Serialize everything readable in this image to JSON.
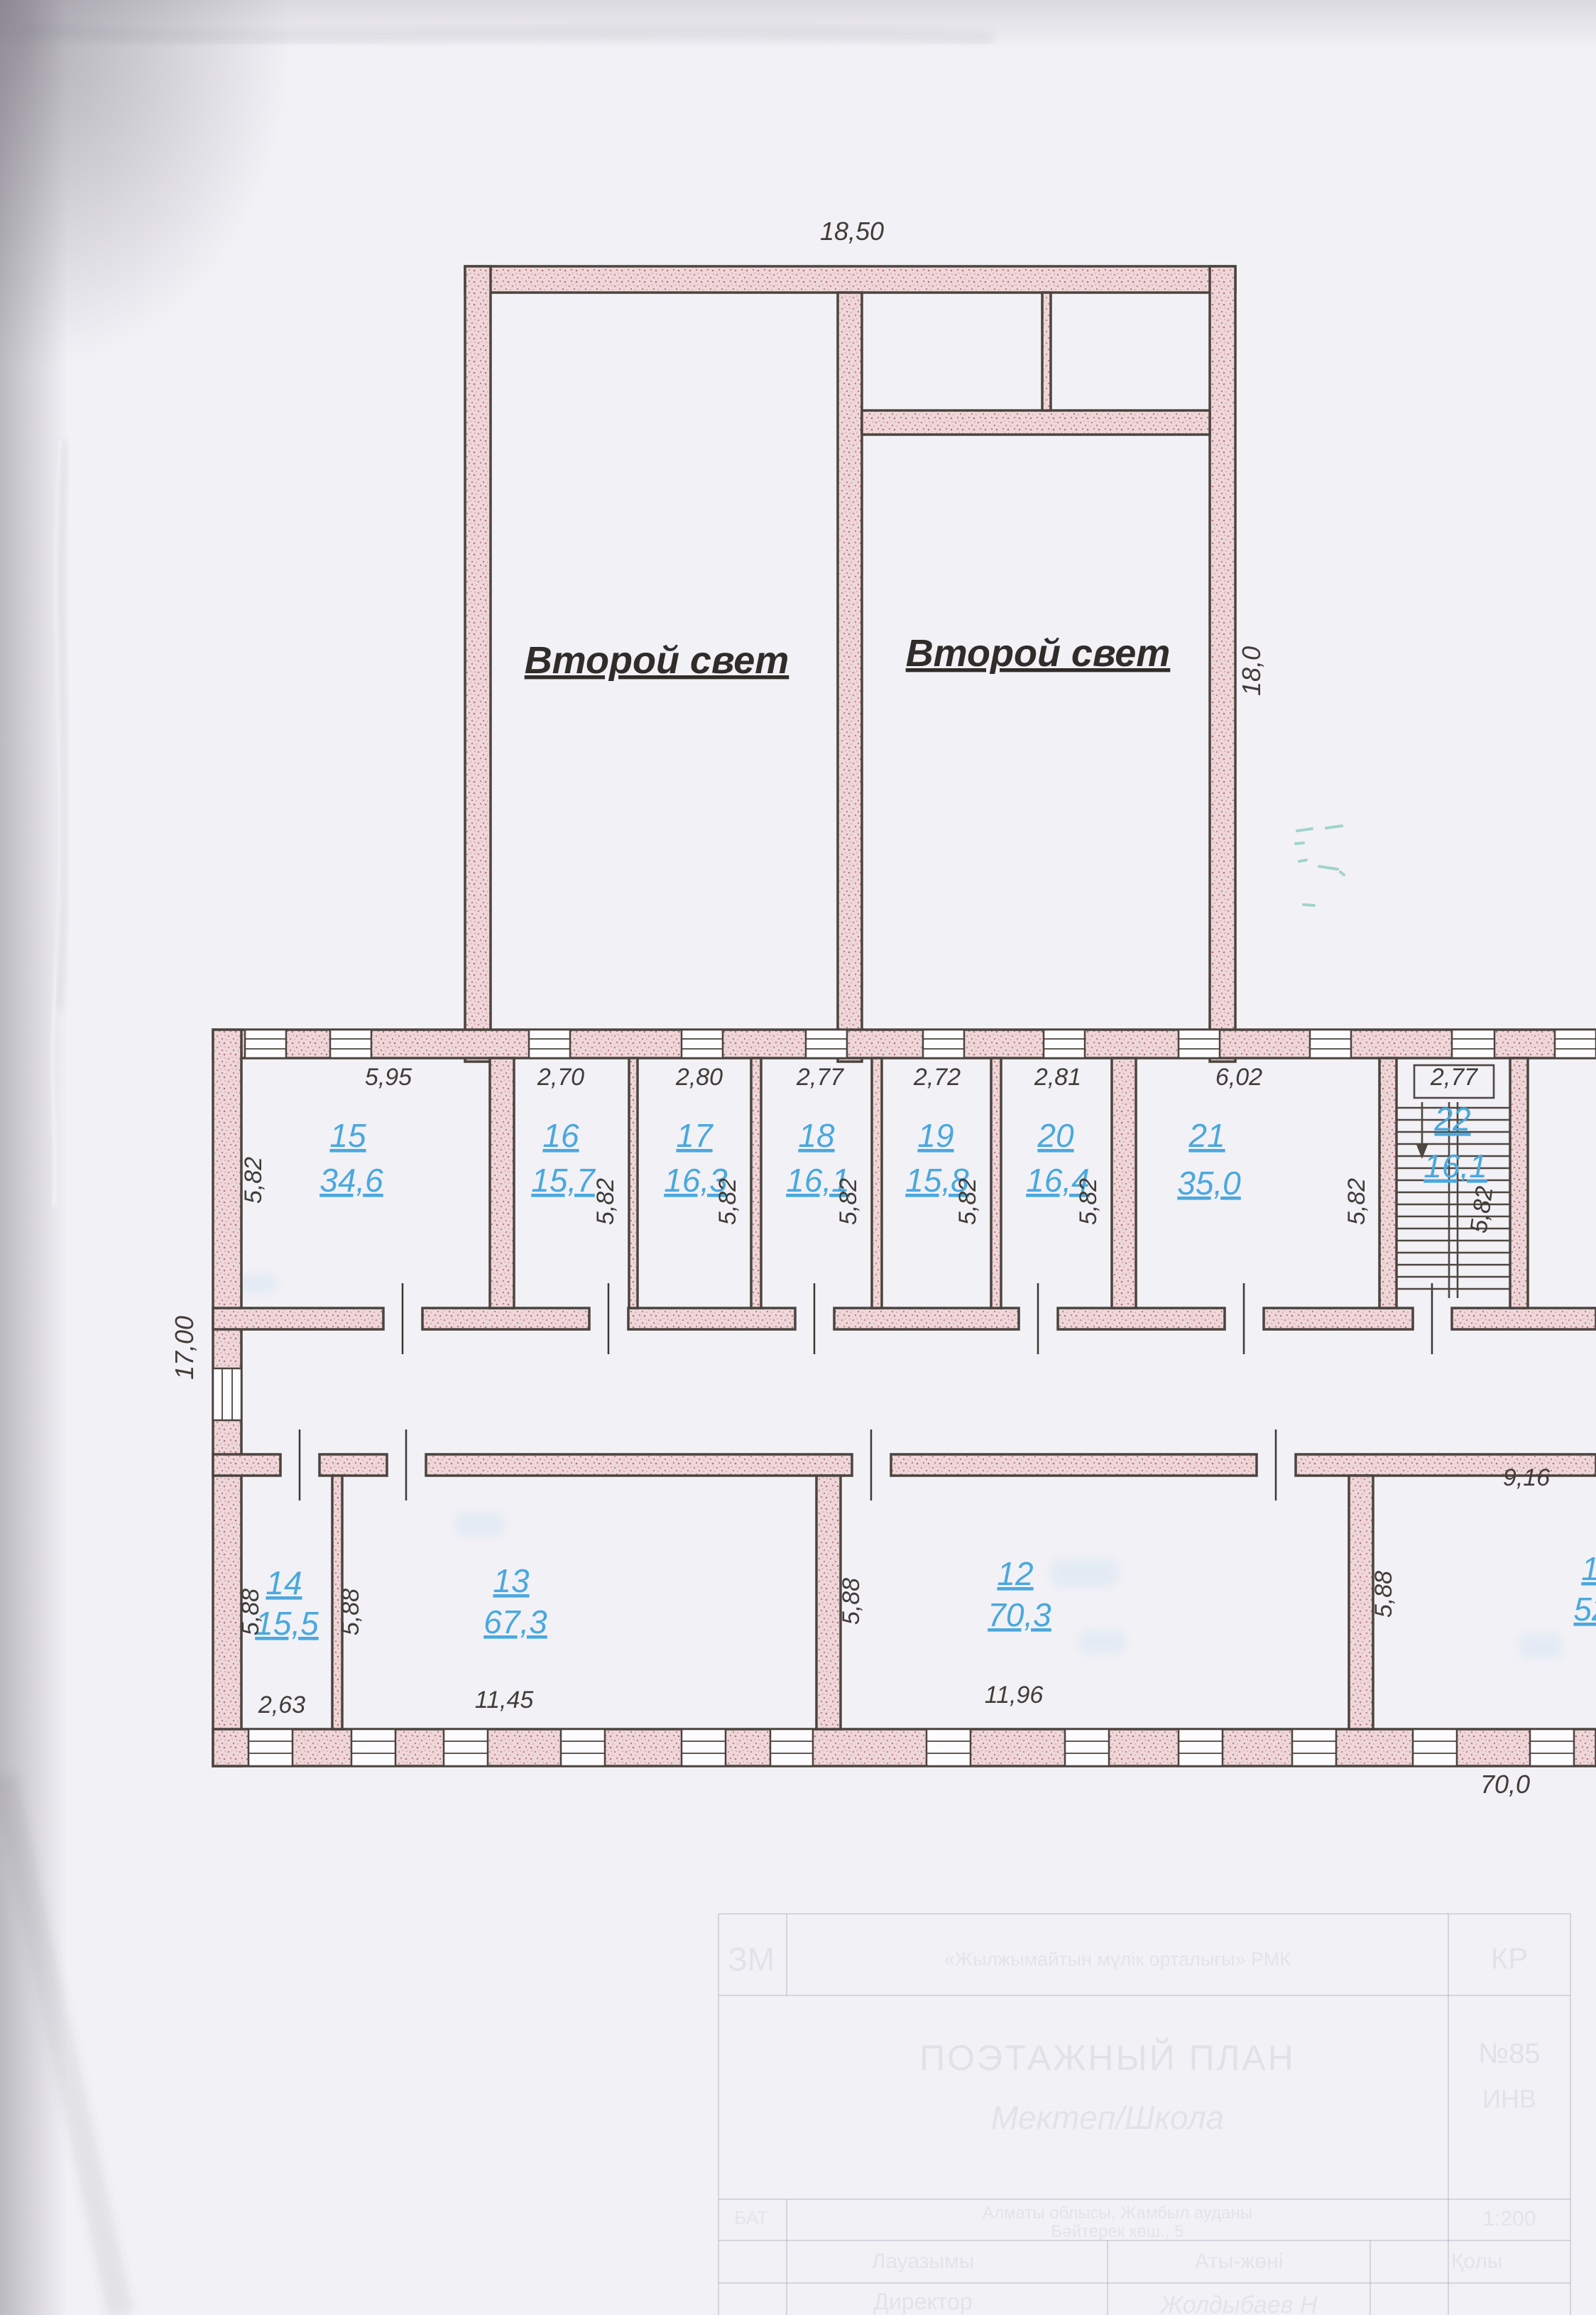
{
  "document": {
    "kind": "scanned floor plan sheet",
    "accent_blue": "#4aa8de",
    "wall_pink": "#eed7d9",
    "paper": "#f2f1f6"
  },
  "annotations": {
    "second_light_left": "Второй свет",
    "second_light_right": "Второй свет"
  },
  "overall_dimensions": {
    "top_width": "18,50",
    "right_height": "18,0",
    "left_height": "17,00",
    "bottom_length": "70,0"
  },
  "upper_rooms": [
    {
      "number": "15",
      "area": "34,6",
      "width": "5,95",
      "depth": "5,82"
    },
    {
      "number": "16",
      "area": "15,7",
      "width": "2,70",
      "depth": "5,82"
    },
    {
      "number": "17",
      "area": "16,3",
      "width": "2,80",
      "depth": "5,82"
    },
    {
      "number": "18",
      "area": "16,1",
      "width": "2,77",
      "depth": "5,82"
    },
    {
      "number": "19",
      "area": "15,8",
      "width": "2,72",
      "depth": "5,82"
    },
    {
      "number": "20",
      "area": "16,4",
      "width": "2,81",
      "depth": "5,82"
    },
    {
      "number": "21",
      "area": "35,0",
      "width": "6,02",
      "depth": "5,82"
    },
    {
      "number": "22",
      "area": "16,1",
      "width": "2,77",
      "depth": "5,82"
    }
  ],
  "lower_rooms": [
    {
      "number": "14",
      "area": "15,5",
      "width": "2,63",
      "depth": "5,88"
    },
    {
      "number": "13",
      "area": "67,3",
      "width": "11,45",
      "depth": "5,88"
    },
    {
      "number": "12",
      "area": "70,3",
      "width": "11,96",
      "depth": "5,88"
    },
    {
      "number": "1",
      "area": "52",
      "width": "9,16",
      "depth": "5,88"
    }
  ],
  "title_block": {
    "org_code_left": "ЗМ",
    "org_name": "«Жылжымайтын мүлік орталығы» РМК",
    "region_code": "КР",
    "plan_title": "ПОЭТАЖНЫЙ ПЛАН",
    "object_name": "Мектеп/Школа",
    "inventory_number": "№85",
    "inventory_label": "ИНВ",
    "left_stub": "БАТ",
    "address_line1": "Алматы облысы, Жамбыл ауданы",
    "address_line2": "Бәйтерек көш., 5",
    "scale": "1:200",
    "col_position": "Лауазымы",
    "col_name": "Аты-жөні",
    "col_signature": "Қолы",
    "row_director": "Директор",
    "director_name": "Жолдыбаев Н"
  }
}
